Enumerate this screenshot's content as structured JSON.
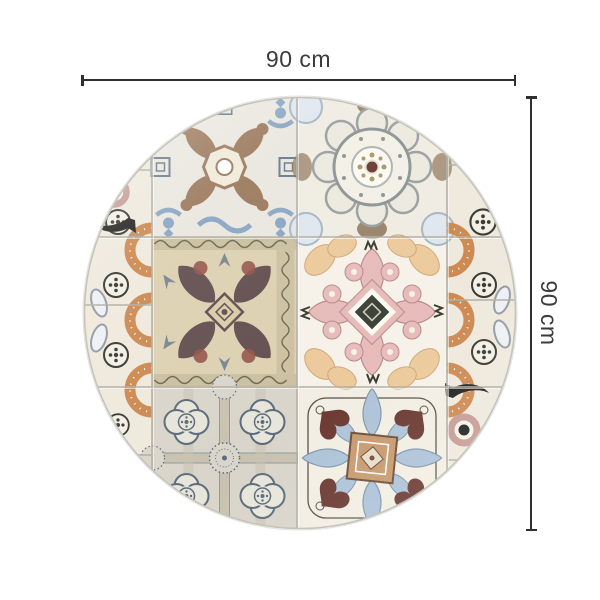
{
  "image": {
    "description": "Round vinyl rug with vintage Mediterranean patchwork tile pattern shown on white background with width and height dimension lines"
  },
  "annotation": {
    "width_label": "90 cm",
    "height_label": "90 cm"
  },
  "rug": {
    "shape": "circle",
    "tiles": [
      "top-left: cream tile, brown leafy cross with octagon medallion, blue corner scrolls, grey greek-key squares",
      "top-right: cream tile, grey circular rosette medallion with maroon center dot, brown damask edges, light-blue corner fleurs",
      "middle-left: tan tile, dark plum damask motif with rust accents and ornate scroll borders",
      "middle-right: white tile, pink scroll cross with dark olive diamond center, peach paisley corners, small dark glyphs",
      "bottom-left: grey tile, slate quatrefoil lattice with rosettes and dashed sunburst medallion",
      "bottom-right: cream tile, tan center square, light-blue acanthus leaves, maroon heart leaves, thin vine border",
      "side strips: terracotta dotted arcs, black dotted medallions, grey leaf ovals, black swallow arrows with mauve target rings"
    ]
  },
  "colors": {
    "background": "#ffffff",
    "line": "#2f2f2f",
    "text": "#3b3b3b",
    "grid": "#b2afa5",
    "rim": "#c6c3ba",
    "cream": "#efe9dd",
    "tl_bg": "#e9e7df",
    "tr_bg": "#f0ece2",
    "ml_bg": "#ddd1b2",
    "mr_bg": "#f6f2e9",
    "bl_bg": "#d9d5ca",
    "br_bg": "#f3eee3",
    "strip_bg": "#efe9dd",
    "blue": "#8aa6c4",
    "lightblue": "#aec3d8",
    "slate": "#5c6c7c",
    "brown": "#9c7a5d",
    "darkbrown": "#8a7355",
    "plum": "#645050",
    "rust": "#94544a",
    "pink": "#e7bcba",
    "peach": "#ecca9c",
    "orange": "#cd8a52",
    "tan": "#c89a6e",
    "maroon": "#6b3a32",
    "olive": "#3e4236",
    "gray": "#939ca6",
    "mauve": "#c69c94",
    "ink": "#222220"
  }
}
